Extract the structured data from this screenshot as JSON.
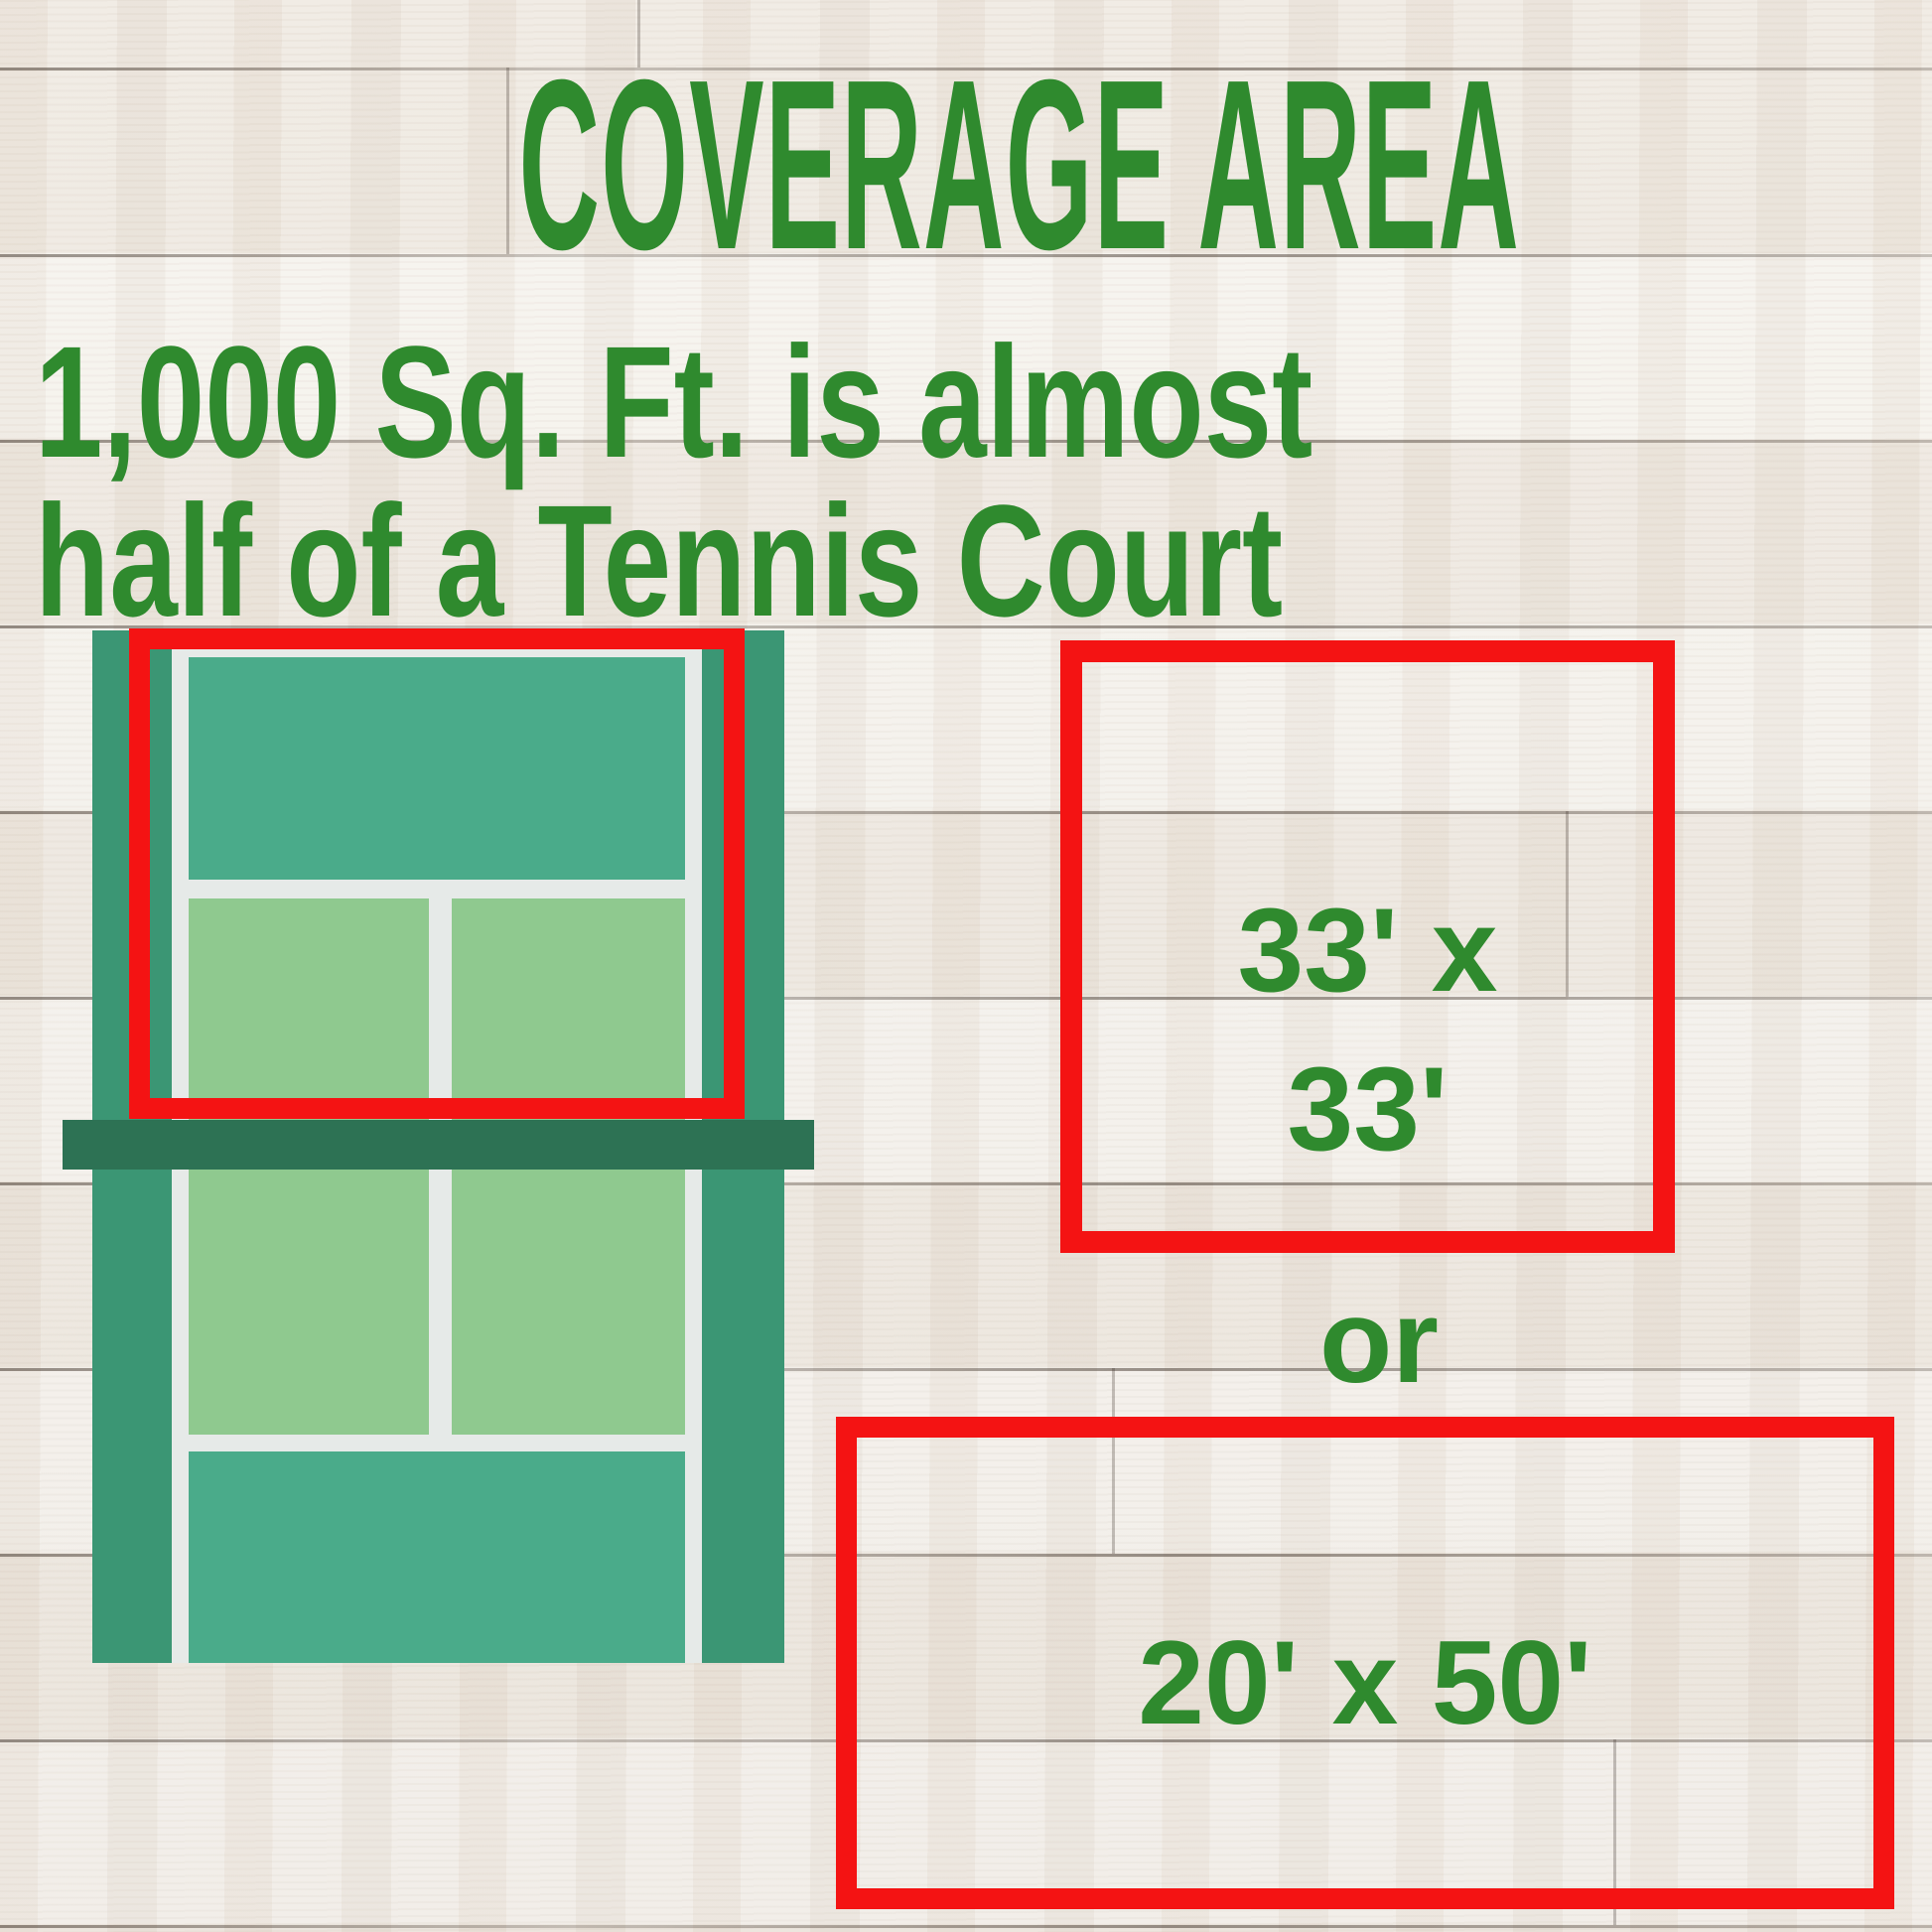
{
  "header": {
    "title": "COVERAGE AREA",
    "subtitle_line1": "1,000 Sq. Ft. is almost",
    "subtitle_line2": "half of a Tennis Court"
  },
  "areas": {
    "square": {
      "line1": "33' x",
      "line2": "33'"
    },
    "conjunction": "or",
    "rectangle": {
      "label": "20' x 50'"
    }
  },
  "colors": {
    "text_green": "#2f8a2e",
    "outline_red": "#f41313",
    "court_band": "#3b9674",
    "court_teal": "#4aab8a",
    "service_box": "#8fc98f",
    "court_line": "#e6eae8",
    "net_green": "#2d7254",
    "wood_base": "#f3f0ea",
    "wood_seam": "#3a2f26"
  }
}
